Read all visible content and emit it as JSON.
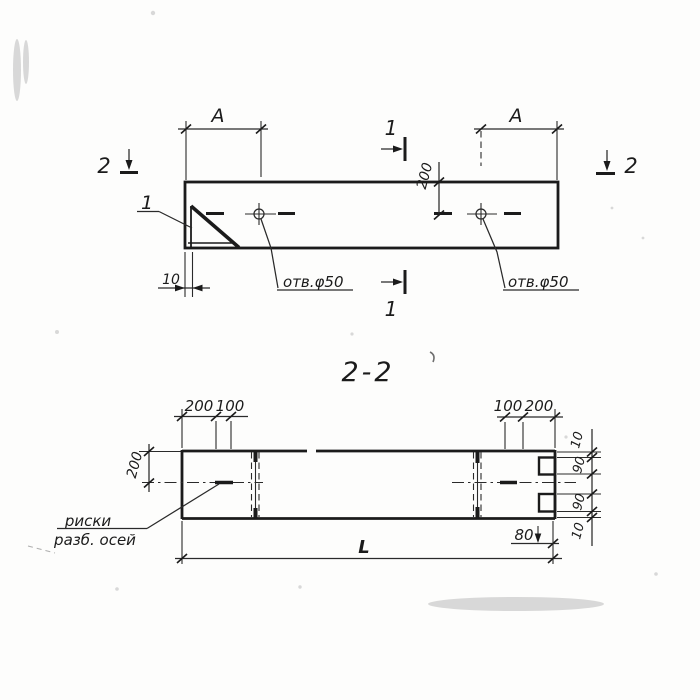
{
  "drawing": {
    "section_title": "2-2",
    "plan_view": {
      "span_dim_left": "A",
      "span_dim_right": "A",
      "hole_offset_dim": "200",
      "end_wall_dim": "10",
      "hole_label_left": "отв.φ50",
      "hole_label_right": "отв.φ50",
      "gusset_item_mark": "1",
      "section_1_mark_top": "1",
      "section_1_mark_bottom": "1",
      "section_2_mark_left": "2",
      "section_2_mark_right": "2"
    },
    "section_view": {
      "top_dims_left": [
        "200",
        "100"
      ],
      "top_dims_right": [
        "100",
        "200"
      ],
      "height_dim": "200",
      "right_dims": [
        "10",
        "90",
        "90",
        "10"
      ],
      "notch_depth_dim": "80",
      "length_dim": "L",
      "axis_note_line1": "риски",
      "axis_note_line2": "разб. осей"
    },
    "ink_color": "#1b1b1b",
    "paper_color": "#fdfdfc"
  }
}
